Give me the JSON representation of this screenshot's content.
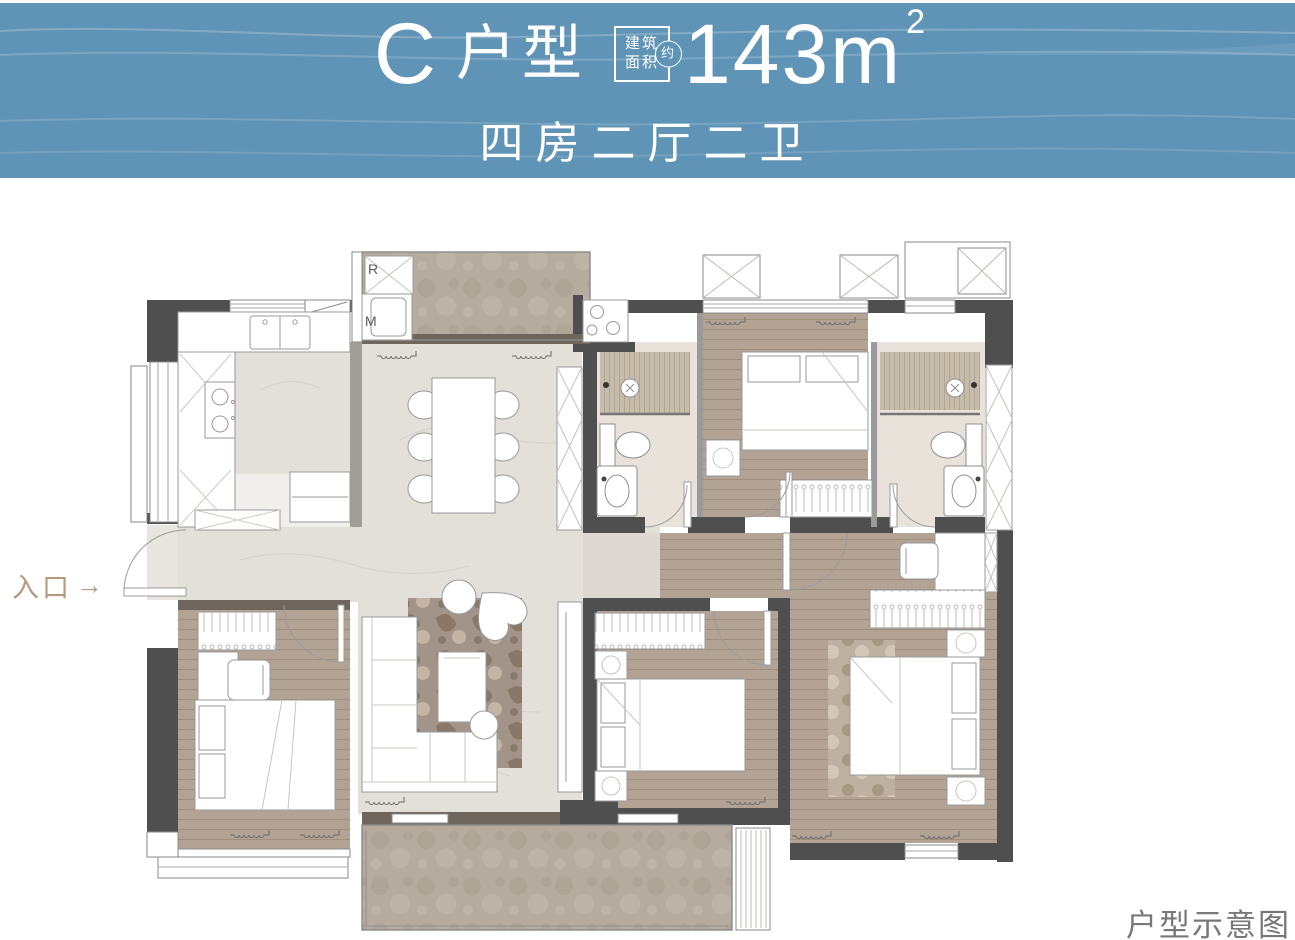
{
  "header": {
    "unit_letter": "C",
    "unit_word": "户型",
    "area_box": {
      "line1": "建筑",
      "line2": "面积",
      "approx": "约"
    },
    "area_value": "143m",
    "area_exponent": "2",
    "subtitle": "四房二厅二卫"
  },
  "plan": {
    "entrance_label": "入口",
    "entrance_arrow": "→",
    "appliance_fridge": "R",
    "appliance_washer": "M",
    "caption": "户型示意图"
  },
  "colors": {
    "banner": "#6094b6",
    "banner_wave": "#8fb3ca",
    "wall": "#4f4f4f",
    "wall_thin": "#9a9a9a",
    "wood_floor": "#b2a395",
    "marble_floor": "#e3dfd9",
    "stone_floor": "#b5ac9f",
    "threshold": "#6e665c",
    "furniture_outline": "#9a9a9a",
    "entrance_text": "#b49b80",
    "caption_text": "#787878"
  }
}
